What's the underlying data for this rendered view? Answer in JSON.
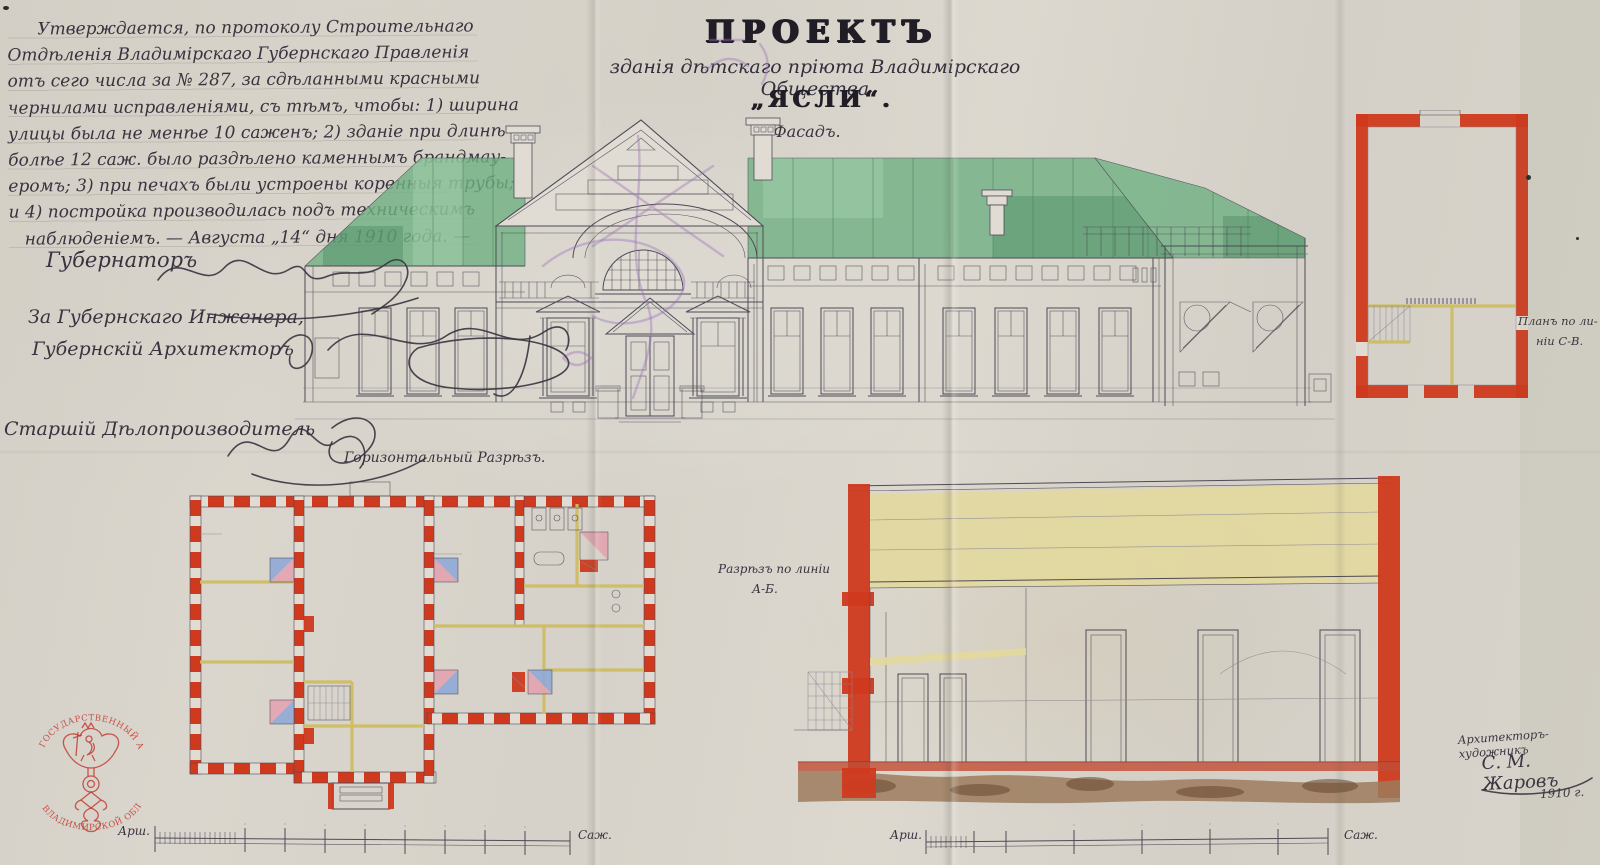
{
  "doc": {
    "approval": {
      "lines": [
        "Утверждается, по протоколу Строительнаго",
        "Отдѣленія Владимірскаго Губернскаго Правленія",
        "отъ сего числа за № 287, за сдѣланными красными",
        "чернилами исправленіями, съ тѣмъ, чтобы: 1) ширина",
        "улицы была не менѣе 10 саженъ; 2) зданіе при длинѣ",
        "болѣе 12 саж. было раздѣлено каменнымъ брандмау-",
        "еромъ; 3) при печахъ были устроены коренныя трубы;",
        "и 4) постройка производилась подъ техническимъ",
        "наблюденіемъ. — Августа „14“ дня 1910 года. —"
      ]
    },
    "title": {
      "project": "ПРОЕКТЪ",
      "subtitle": "зданія дѣтскаго пріюта Владимірскаго Общества",
      "name": "„ЯСЛИ“.",
      "facade_label": "Фасадъ."
    },
    "officials": {
      "governor": "Губернаторъ",
      "engineer_line1": "За Губернскаго Инженера,",
      "engineer_line2": "Губернскій Архитекторъ",
      "clerk": "Старшій Дѣлопроизводитель"
    },
    "labels": {
      "floor_plan": "Горизонтальный Разрѣзъ.",
      "section_line1": "Разрѣзъ по линіи",
      "section_line2": "А-Б.",
      "side_plan_line1": "Планъ по ли-",
      "side_plan_line2": "ніи С-В."
    },
    "architect": {
      "role": "Архитекторъ-художникъ",
      "name": "С. М. Жаровъ",
      "year": "1910 г."
    },
    "scale": {
      "arshins": "Арш.",
      "sazhens": "Саж."
    },
    "stamp": {
      "arc_top": "ГОСУДАРСТВЕННЫЙ АРХИВ",
      "arc_bottom": "ВЛАДИМИРСКОЙ ОБЛАСТИ"
    }
  },
  "colors": {
    "paper": "#d7d3ca",
    "paper_light": "#e0dcd3",
    "ink": "#4e4a57",
    "pencil": "#8a8694",
    "hand": "#38333f",
    "roof_green": "#6fb082",
    "roof_green_dark": "#3f7f58",
    "roof_green_light": "#a9d6b4",
    "wall_red": "#cf3a1e",
    "partition_yellow": "#cdbd62",
    "stove_blue": "#8fa8d6",
    "stove_pink": "#e2a3b0",
    "attic_yellow": "#e3d89d",
    "foundation_brown": "#9c7b5d",
    "foundation_dark": "#6d4c35",
    "brick_strip": "#c24c36",
    "stamp_red": "#bf3026",
    "purple": "#9a71b8"
  }
}
